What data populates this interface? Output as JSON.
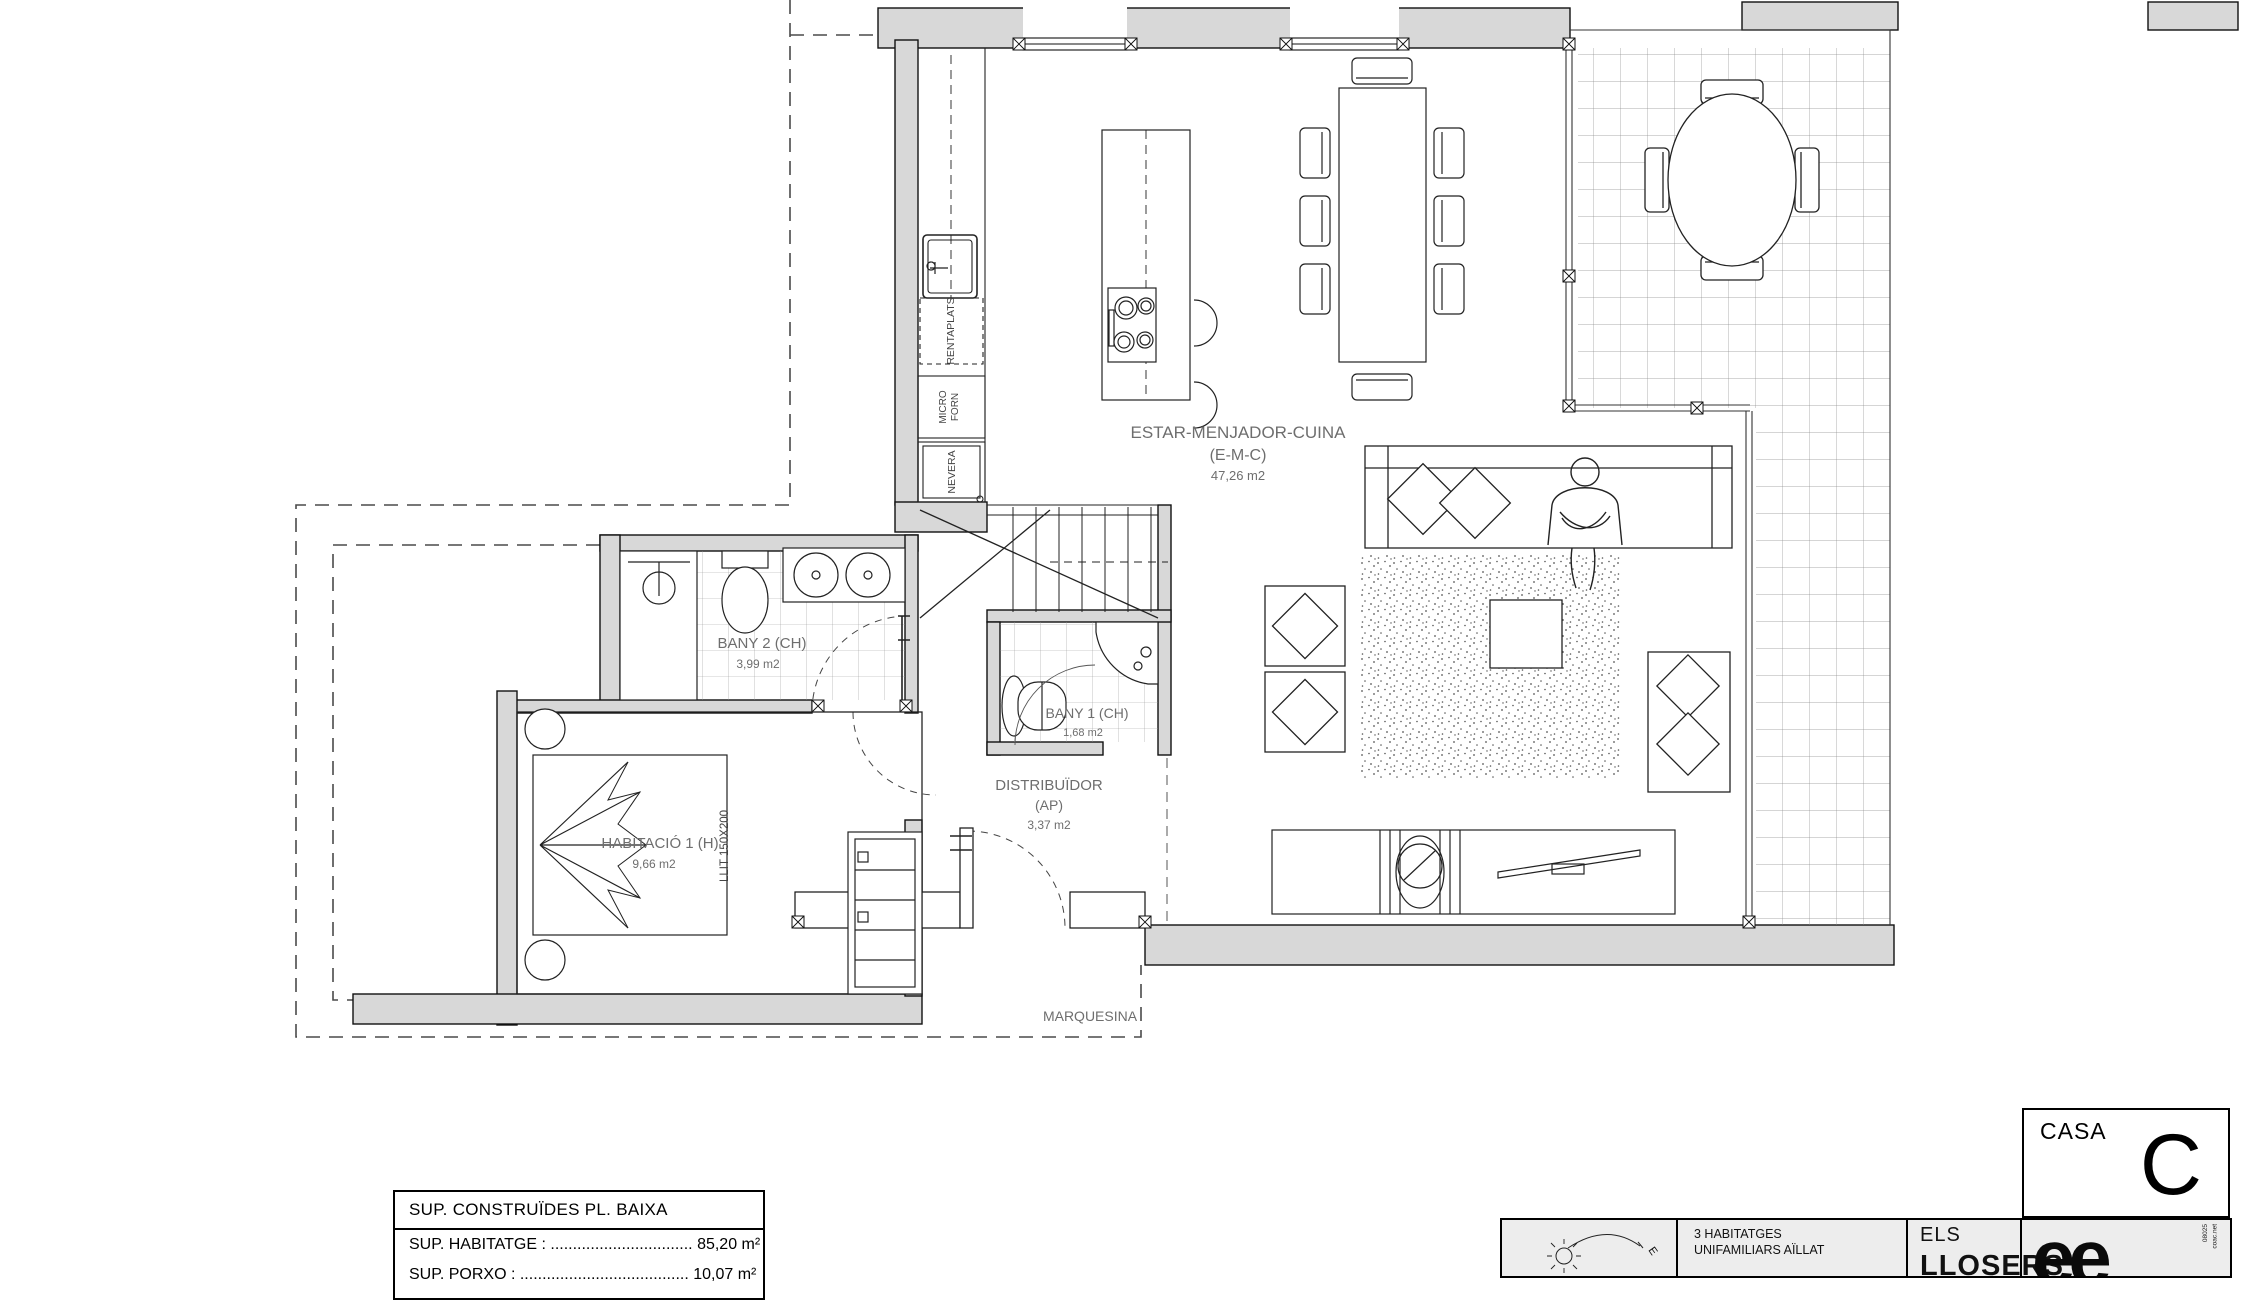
{
  "rooms": {
    "emc": {
      "l1": "ESTAR-MENJADOR-CUINA",
      "l2": "(E-M-C)",
      "l3": "47,26 m2"
    },
    "bany2": {
      "l1": "BANY 2 (CH)",
      "l2": "3,99 m2"
    },
    "bany1": {
      "l1": "BANY 1 (CH)",
      "l2": "1,68 m2"
    },
    "dist": {
      "l1": "DISTRIBUÏDOR",
      "l2": "(AP)",
      "l3": "3,37 m2"
    },
    "hab": {
      "l1": "HABITACIÓ 1 (H)",
      "l2": "9,66 m2"
    }
  },
  "labels": {
    "marquesina": "MARQUESINA",
    "llit": "LLIT 150X200",
    "rentaplats": "RENTAPLATS",
    "micro": "MICRO",
    "forn": "FORN",
    "nevera": "NEVERA"
  },
  "areas_table": {
    "title": "SUP. CONSTRUÏDES PL. BAIXA",
    "row_habitatge": "SUP. HABITATGE : ................................ 85,20 m²",
    "row_porxo": "SUP. PORXO : ...................................... 10,07 m²"
  },
  "title_block": {
    "casa": "CASA",
    "letter": "C",
    "project_line1": "3 HABITATGES",
    "project_line2": "UNIFAMILIARS AÏLLAT",
    "els": "ELS",
    "name": "LLOSERS",
    "logo": "ee",
    "side1": "08025",
    "side2": "coac.net",
    "east": "E"
  },
  "colors": {
    "wall": "#d8d8d8",
    "line": "#1a1a1a",
    "label": "#6e6e6e",
    "strip_bg": "#ededed"
  }
}
